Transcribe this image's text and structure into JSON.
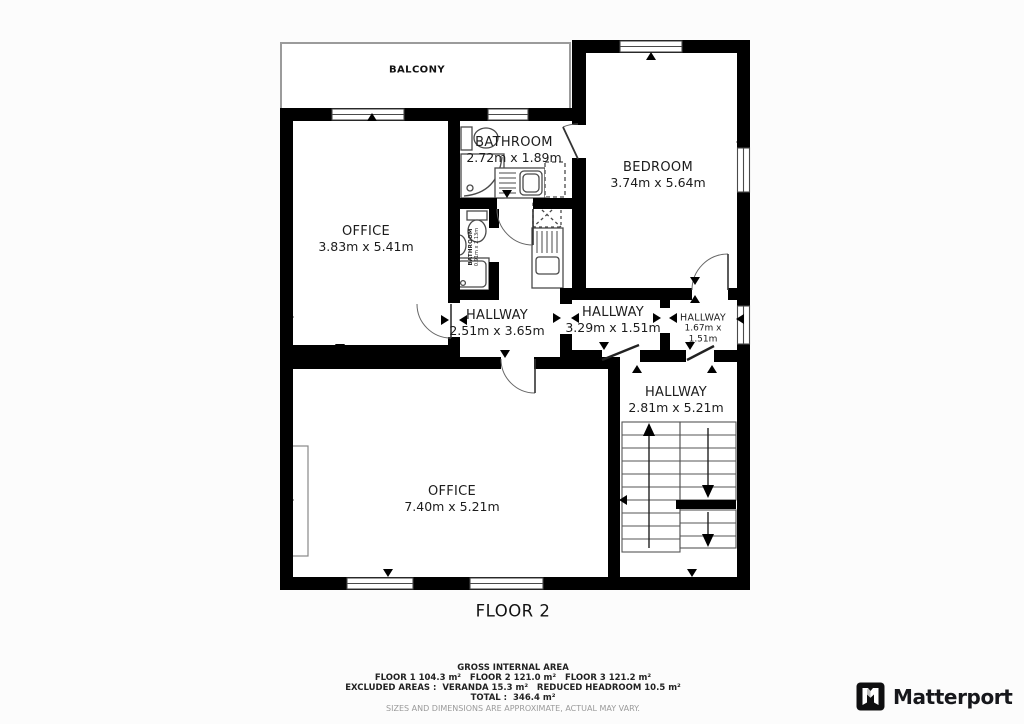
{
  "rooms": {
    "balcony": {
      "label": "BALCONY"
    },
    "bathroom": {
      "label": "BATHROOM",
      "dims": "2.72m x 1.89m"
    },
    "bathroom_small": {
      "label": "BATHROOM",
      "dims": "0.91m x 2.13m"
    },
    "bedroom": {
      "label": "BEDROOM",
      "dims": "3.74m x 5.64m"
    },
    "office_top": {
      "label": "OFFICE",
      "dims": "3.83m x 5.41m"
    },
    "hallway_main": {
      "label": "HALLWAY",
      "dims": "2.51m x 3.65m"
    },
    "hallway_mid": {
      "label": "HALLWAY",
      "dims": "3.29m x 1.51m"
    },
    "hallway_small": {
      "label": "HALLWAY",
      "dims_line1": "1.67m x",
      "dims_line2": "1.51m"
    },
    "hallway_stairs": {
      "label": "HALLWAY",
      "dims": "2.81m x 5.21m"
    },
    "office_bottom": {
      "label": "OFFICE",
      "dims": "7.40m x 5.21m"
    }
  },
  "floor": {
    "label": "FLOOR 2"
  },
  "summary": {
    "title": "GROSS INTERNAL AREA",
    "floors": "FLOOR 1 104.3 m²   FLOOR 2 121.0 m²   FLOOR 3 121.2 m²",
    "excluded": "EXCLUDED AREAS :  VERANDA 15.3 m²   REDUCED HEADROOM 10.5 m²",
    "total": "TOTAL :  346.4 m²",
    "disclaimer": "SIZES AND DIMENSIONS ARE APPROXIMATE, ACTUAL MAY VARY."
  },
  "branding": {
    "name": "Matterport"
  },
  "colors": {
    "wall": "#000000",
    "fixture_line": "#4a4a4a",
    "balcony_line": "#9b9b9b",
    "text": "#1c1c1c",
    "muted_text": "#9a9a9a"
  }
}
